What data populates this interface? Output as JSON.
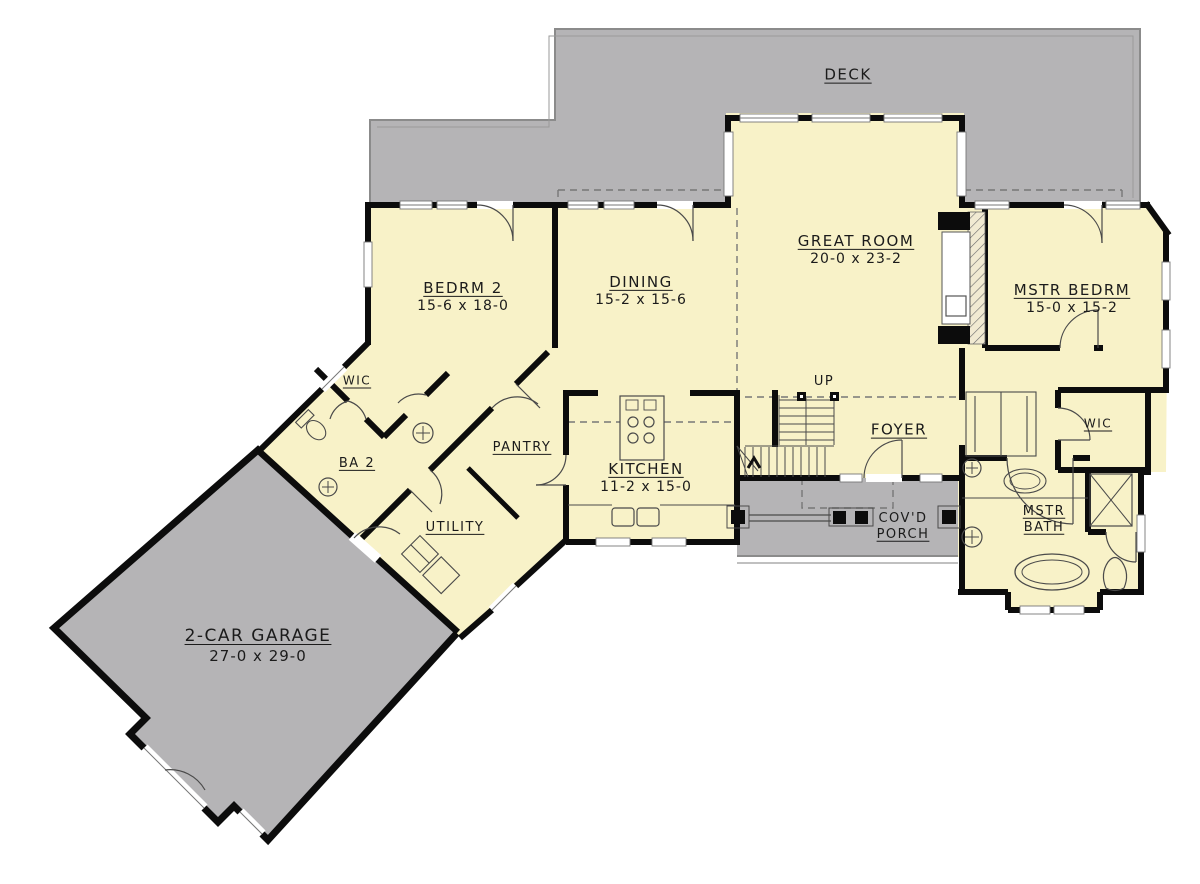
{
  "document": {
    "type": "floor-plan",
    "view": "main-level"
  },
  "colors": {
    "interior_fill": "#f8f2c8",
    "deck_garage_porch_fill": "#b5b4b6",
    "wall": "#0c0c0c",
    "thin_line": "#4a4a4a",
    "dashed_line": "#777777",
    "text": "#1b1b1b",
    "background": "#ffffff"
  },
  "labels": {
    "deck": {
      "name": "DECK"
    },
    "great_room": {
      "name": "GREAT ROOM",
      "dims": "20-0 x 23-2"
    },
    "mstr_bedrm": {
      "name": "MSTR BEDRM",
      "dims": "15-0 x 15-2"
    },
    "bedrm_2": {
      "name": "BEDRM 2",
      "dims": "15-6 x 18-0"
    },
    "dining": {
      "name": "DINING",
      "dims": "15-2 x 15-6"
    },
    "kitchen": {
      "name": "KITCHEN",
      "dims": "11-2 x 15-0"
    },
    "pantry": {
      "name": "PANTRY"
    },
    "utility": {
      "name": "UTILITY"
    },
    "wic_bedrm2": {
      "name": "WIC"
    },
    "wic_master": {
      "name": "WIC"
    },
    "ba_2": {
      "name": "BA 2"
    },
    "foyer": {
      "name": "FOYER"
    },
    "up": {
      "name": "UP"
    },
    "covd_porch": {
      "line1": "COV'D",
      "line2": "PORCH"
    },
    "mstr_bath": {
      "line1": "MSTR",
      "line2": "BATH"
    },
    "garage": {
      "name": "2-CAR GARAGE",
      "dims": "27-0 x 29-0"
    }
  }
}
